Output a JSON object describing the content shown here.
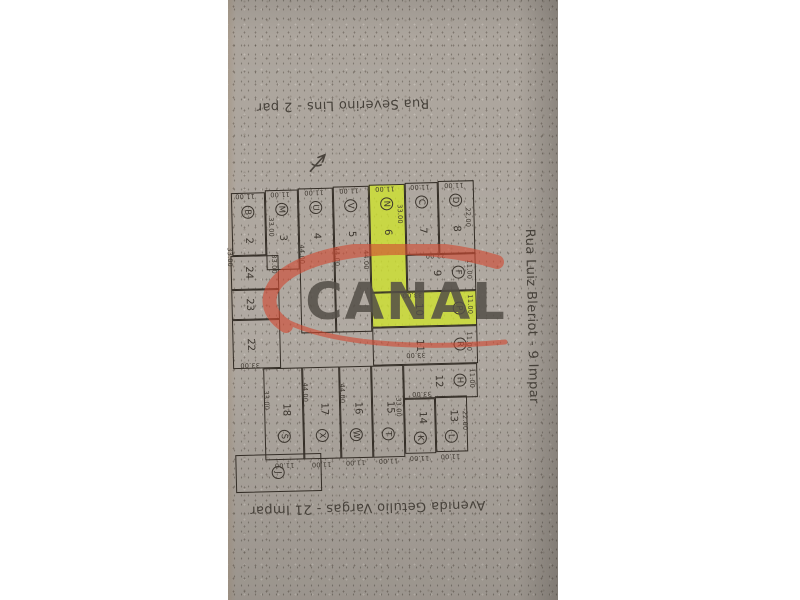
{
  "photo": {
    "background": "#ffffff",
    "paper_color": "#aca59d",
    "paper_left": 228,
    "paper_width": 330
  },
  "map": {
    "line_color": "#332d26",
    "highlight_color": "#d0e42c",
    "streets": {
      "top": {
        "label": "Rua Severino Lins - 2 par"
      },
      "right": {
        "label": "Rua Luiz Bleriot - 9 Impar"
      },
      "bottom": {
        "label": "Avenida Getúlio Vargas - 21 Impar"
      }
    },
    "watermark": {
      "text": "CANAL",
      "swoosh_color": "#d24a32",
      "text_color": "#534e47"
    },
    "north_arrow_icon": "north-arrow-sketch",
    "highlighted_lots": [
      "6",
      "10"
    ],
    "lots": [
      {
        "number": "2",
        "letter": "B",
        "x": 234,
        "y": 190,
        "w": 34,
        "h": 63,
        "layout": "v-top",
        "highlighted": false
      },
      {
        "number": "3",
        "letter": "M",
        "x": 268,
        "y": 188,
        "w": 33,
        "h": 80,
        "layout": "v-top",
        "highlighted": false
      },
      {
        "number": "4",
        "letter": "U",
        "x": 301,
        "y": 187,
        "w": 35,
        "h": 145,
        "layout": "v-top",
        "highlighted": false
      },
      {
        "number": "5",
        "letter": "V",
        "x": 336,
        "y": 186,
        "w": 36,
        "h": 146,
        "layout": "v-top",
        "highlighted": false
      },
      {
        "number": "6",
        "letter": "N",
        "x": 372,
        "y": 185,
        "w": 36,
        "h": 108,
        "layout": "v-top",
        "highlighted": true
      },
      {
        "number": "7",
        "letter": "C",
        "x": 408,
        "y": 184,
        "w": 33,
        "h": 72,
        "layout": "v-top",
        "highlighted": false
      },
      {
        "number": "8",
        "letter": "D",
        "x": 441,
        "y": 183,
        "w": 36,
        "h": 73,
        "layout": "v-top",
        "highlighted": false
      },
      {
        "number": "9",
        "letter": "F",
        "x": 408,
        "y": 256,
        "w": 69,
        "h": 37,
        "layout": "h-row",
        "highlighted": false
      },
      {
        "number": "10",
        "letter": "P",
        "x": 372,
        "y": 293,
        "w": 105,
        "h": 35,
        "layout": "h-row",
        "highlighted": true
      },
      {
        "number": "11",
        "letter": "R",
        "x": 372,
        "y": 328,
        "w": 105,
        "h": 38,
        "layout": "h-row",
        "highlighted": false
      },
      {
        "number": "12",
        "letter": "H",
        "x": 402,
        "y": 366,
        "w": 74,
        "h": 34,
        "layout": "h-row",
        "highlighted": false
      },
      {
        "number": "14",
        "letter": "K",
        "x": 402,
        "y": 400,
        "w": 31,
        "h": 55,
        "layout": "v-bot-sm",
        "highlighted": false
      },
      {
        "number": "13",
        "letter": "L",
        "x": 433,
        "y": 398,
        "w": 32,
        "h": 56,
        "layout": "v-bot-sm",
        "highlighted": false
      },
      {
        "number": "15",
        "letter": "T",
        "x": 370,
        "y": 366,
        "w": 32,
        "h": 92,
        "layout": "v-bottom",
        "highlighted": false
      },
      {
        "number": "16",
        "letter": "W",
        "x": 338,
        "y": 366,
        "w": 32,
        "h": 92,
        "layout": "v-bottom",
        "highlighted": false
      },
      {
        "number": "17",
        "letter": "X",
        "x": 301,
        "y": 366,
        "w": 37,
        "h": 92,
        "layout": "v-bottom",
        "highlighted": false
      },
      {
        "number": "18",
        "letter": "S",
        "x": 262,
        "y": 366,
        "w": 39,
        "h": 92,
        "layout": "v-bottom",
        "highlighted": false
      },
      {
        "number": "24",
        "letter": "",
        "x": 232,
        "y": 253,
        "w": 48,
        "h": 34,
        "layout": "plain",
        "highlighted": false
      },
      {
        "number": "23",
        "letter": "",
        "x": 232,
        "y": 287,
        "w": 48,
        "h": 30,
        "layout": "plain",
        "highlighted": false
      },
      {
        "number": "22",
        "letter": "",
        "x": 232,
        "y": 317,
        "w": 48,
        "h": 49,
        "layout": "plain",
        "highlighted": false
      },
      {
        "number": "",
        "letter": "J",
        "x": 232,
        "y": 452,
        "w": 86,
        "h": 38,
        "layout": "letter-only",
        "highlighted": false
      }
    ],
    "dimensions": [
      {
        "t": "11.00",
        "x": 248,
        "y": 193,
        "r": 180
      },
      {
        "t": "11.00",
        "x": 283,
        "y": 192,
        "r": 180
      },
      {
        "t": "11.00",
        "x": 317,
        "y": 191,
        "r": 180
      },
      {
        "t": "11.00",
        "x": 352,
        "y": 190,
        "r": 180
      },
      {
        "t": "11.00",
        "x": 388,
        "y": 189,
        "r": 180
      },
      {
        "t": "11.00",
        "x": 423,
        "y": 188,
        "r": 180
      },
      {
        "t": "11.00",
        "x": 457,
        "y": 187,
        "r": 180
      },
      {
        "t": "11.00",
        "x": 281,
        "y": 463,
        "r": 180
      },
      {
        "t": "11.00",
        "x": 318,
        "y": 463,
        "r": 180
      },
      {
        "t": "11.00",
        "x": 352,
        "y": 462,
        "r": 180
      },
      {
        "t": "11.00",
        "x": 385,
        "y": 461,
        "r": 180
      },
      {
        "t": "11.00",
        "x": 416,
        "y": 459,
        "r": 180
      },
      {
        "t": "11.00",
        "x": 447,
        "y": 458,
        "r": 180
      },
      {
        "t": "22.00",
        "x": 437,
        "y": 257,
        "r": 180
      },
      {
        "t": "33.00",
        "x": 413,
        "y": 296,
        "r": 180
      },
      {
        "t": "33.00",
        "x": 415,
        "y": 356,
        "r": 180
      },
      {
        "t": "33.00",
        "x": 420,
        "y": 395,
        "r": 180
      },
      {
        "t": "33.00",
        "x": 249,
        "y": 362,
        "r": 180
      },
      {
        "t": "33.00",
        "x": 273,
        "y": 225,
        "r": 90
      },
      {
        "t": "33.00",
        "x": 402,
        "y": 215,
        "r": 90
      },
      {
        "t": "33.00",
        "x": 396,
        "y": 408,
        "r": 90
      },
      {
        "t": "33.00",
        "x": 264,
        "y": 398,
        "r": 90
      },
      {
        "t": "33.00",
        "x": 275,
        "y": 262,
        "r": 90
      },
      {
        "t": "33.00",
        "x": 231,
        "y": 254,
        "r": 90
      },
      {
        "t": "44.00",
        "x": 303,
        "y": 253,
        "r": 90
      },
      {
        "t": "44.00",
        "x": 338,
        "y": 256,
        "r": 90
      },
      {
        "t": "44.00",
        "x": 367,
        "y": 260,
        "r": 90
      },
      {
        "t": "44.00",
        "x": 340,
        "y": 393,
        "r": 90
      },
      {
        "t": "44.00",
        "x": 303,
        "y": 391,
        "r": 90
      },
      {
        "t": "22.00",
        "x": 470,
        "y": 220,
        "r": 90
      },
      {
        "t": "22.00",
        "x": 462,
        "y": 423,
        "r": 90
      },
      {
        "t": "11.00",
        "x": 470,
        "y": 272,
        "r": 90
      },
      {
        "t": "11.00",
        "x": 470,
        "y": 307,
        "r": 90
      },
      {
        "t": "11.00",
        "x": 468,
        "y": 344,
        "r": 90
      },
      {
        "t": "11.00",
        "x": 470,
        "y": 381,
        "r": 90
      }
    ]
  }
}
